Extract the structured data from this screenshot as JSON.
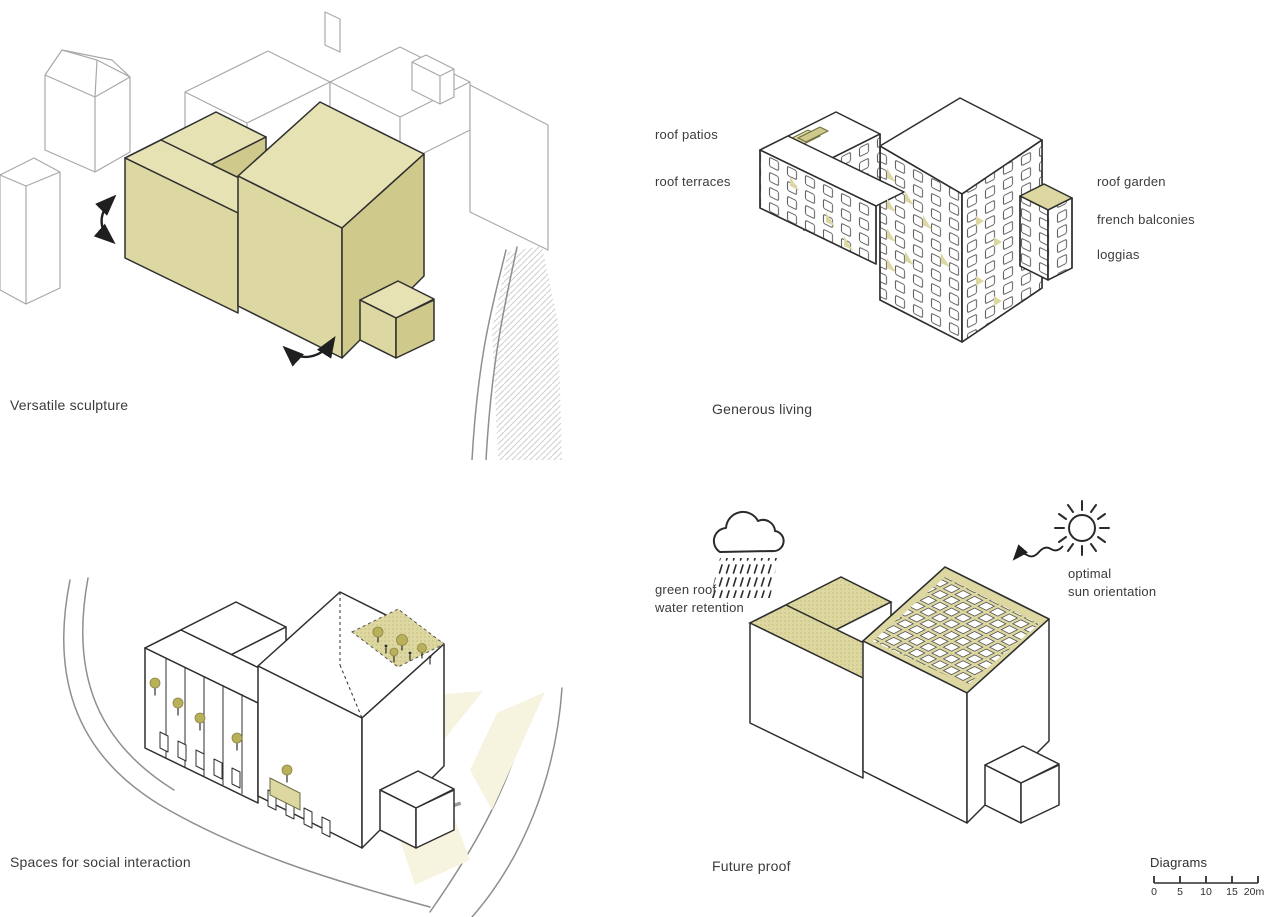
{
  "colors": {
    "accent": "#ddd8a2",
    "accent_top": "#e6e2b4",
    "accent_dark": "#cfc98b",
    "tree": "#b9b05a",
    "plaza": "#f6f3df",
    "ink": "#2f2f2f",
    "context": "#a9a9a9",
    "road": "#8f8f8f",
    "hatch": "#cfcfcf"
  },
  "panels": {
    "versatile_sculpture": {
      "caption": "Versatile sculpture"
    },
    "generous_living": {
      "caption": "Generous living",
      "labels_left": [
        "roof patios",
        "roof terraces"
      ],
      "labels_right": [
        "roof garden",
        "french balconies",
        "loggias"
      ]
    },
    "social_interaction": {
      "caption": "Spaces for social interaction"
    },
    "future_proof": {
      "caption": "Future proof",
      "rain_label": [
        "green roof",
        "water retention"
      ],
      "sun_label": [
        "optimal",
        "sun orientation"
      ]
    }
  },
  "scalebar": {
    "title": "Diagrams",
    "ticks": [
      "0",
      "5",
      "10",
      "15",
      "20m"
    ]
  }
}
